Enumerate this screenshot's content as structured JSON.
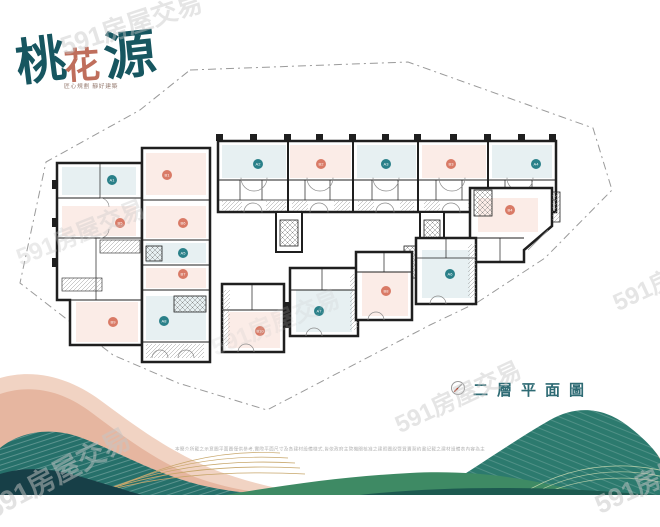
{
  "brand": {
    "char_1": "桃",
    "char_2": "花",
    "char_3": "源",
    "subtitle": "匠心規劃 靜好建築",
    "teal": "#175660",
    "coral": "#bf6e5c"
  },
  "plan_title": {
    "label": "二層平面圖",
    "color": "#2e6b74"
  },
  "compass": {
    "icon": "compass-icon"
  },
  "disclaimer": {
    "text": "本簡介所載之示意圖平面圖僅供參考,實際平面尺寸及各建材設備樣式,皆依政府主管機關核准之建照圖說暨買賣契約書記載之建材設備表內容為主"
  },
  "unit_colors": {
    "teal": "#2a8089",
    "coral": "#d97a66"
  },
  "units": [
    {
      "id": "A1",
      "label": "A1",
      "color": "teal",
      "x": 112,
      "y": 180
    },
    {
      "id": "B1",
      "label": "B1",
      "color": "coral",
      "x": 167,
      "y": 175
    },
    {
      "id": "A2",
      "label": "A2",
      "color": "teal",
      "x": 258,
      "y": 164
    },
    {
      "id": "B2",
      "label": "B2",
      "color": "coral",
      "x": 321,
      "y": 164
    },
    {
      "id": "A3",
      "label": "A3",
      "color": "teal",
      "x": 386,
      "y": 164
    },
    {
      "id": "B3",
      "label": "B3",
      "color": "coral",
      "x": 451,
      "y": 164
    },
    {
      "id": "A4",
      "label": "A4",
      "color": "teal",
      "x": 536,
      "y": 164
    },
    {
      "id": "B4",
      "label": "B4",
      "color": "coral",
      "x": 510,
      "y": 210
    },
    {
      "id": "B5",
      "label": "B5",
      "color": "coral",
      "x": 120,
      "y": 223
    },
    {
      "id": "B6",
      "label": "B6",
      "color": "coral",
      "x": 183,
      "y": 223
    },
    {
      "id": "A5",
      "label": "A5",
      "color": "teal",
      "x": 183,
      "y": 253
    },
    {
      "id": "B7",
      "label": "B7",
      "color": "coral",
      "x": 183,
      "y": 274
    },
    {
      "id": "A6",
      "label": "A6",
      "color": "teal",
      "x": 450,
      "y": 274
    },
    {
      "id": "B8",
      "label": "B8",
      "color": "coral",
      "x": 386,
      "y": 291
    },
    {
      "id": "A7",
      "label": "A7",
      "color": "teal",
      "x": 319,
      "y": 311
    },
    {
      "id": "A8",
      "label": "A8",
      "color": "teal",
      "x": 164,
      "y": 321
    },
    {
      "id": "B9",
      "label": "B9",
      "color": "coral",
      "x": 113,
      "y": 322
    },
    {
      "id": "B10",
      "label": "B10",
      "color": "coral",
      "x": 260,
      "y": 331
    }
  ],
  "watermark": {
    "text": "591房屋交易",
    "color": "#c6c6c6",
    "positions": [
      {
        "x": 55,
        "y": 28,
        "rot": -18,
        "size": 26,
        "opacity": 0.45
      },
      {
        "x": 10,
        "y": 240,
        "rot": -22,
        "size": 24,
        "opacity": 0.35
      },
      {
        "x": 205,
        "y": 330,
        "rot": -22,
        "size": 24,
        "opacity": 0.2
      },
      {
        "x": 388,
        "y": 408,
        "rot": -25,
        "size": 24,
        "opacity": 0.45
      },
      {
        "x": 606,
        "y": 286,
        "rot": -25,
        "size": 24,
        "opacity": 0.45
      },
      {
        "x": 588,
        "y": 488,
        "rot": -25,
        "size": 26,
        "opacity": 0.5
      },
      {
        "x": -22,
        "y": 492,
        "rot": -28,
        "size": 28,
        "opacity": 0.5
      }
    ]
  },
  "palette": {
    "wall": "#1f1f1f",
    "room_blue": "#e7f0f2",
    "room_pink": "#fbece7",
    "boundary": "#9a9a9a",
    "mountain_pink": "#e6b6a0",
    "mountain_pink_light": "#f1d3c3",
    "mountain_teal": "#26706a",
    "mountain_green": "#3e8a64",
    "mountain_dark": "#173f47",
    "mountain_gold": "#c7a66a",
    "mountain_peach": "#edc5ad"
  }
}
